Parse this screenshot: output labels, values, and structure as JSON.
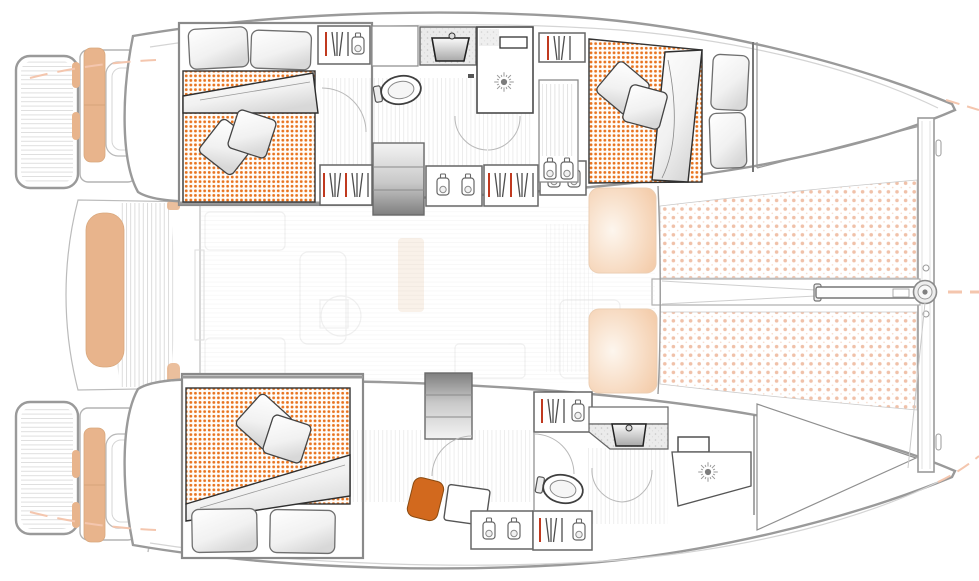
{
  "diagram": {
    "title": "Catamaran interior layout plan (top view)",
    "type": "boat-floor-plan",
    "view": "top-down",
    "orientation": {
      "bow": "right",
      "stern": "left"
    },
    "text_labels": [],
    "colors": {
      "mattress_dot": "#e8731e",
      "trampoline_dot": "#f0c1a9",
      "trampoline_dot_small": "#f7dccd",
      "upholstery_tan": "#e8b48c",
      "chair_orange": "#d2691e",
      "hanger_red": "#c0391f",
      "accent_dash": "#f4c6ae",
      "hull_outline": "#9a9a9a",
      "furniture_outline": "#4a4a4a",
      "window_glow": "#f2c49d"
    },
    "zones": {
      "starboard_hull_top": {
        "rooms": [
          {
            "name": "aft-cabin",
            "features": [
              "double-bed",
              "two-head-pillows",
              "two-decor-pillows",
              "dotted-mattress",
              "folded-duvet"
            ]
          },
          {
            "name": "corridor",
            "features": [
              "hanging-locker",
              "companionway-steps",
              "shelf-unit-bottles",
              "hanging-locker",
              "shelf-unit-bottles"
            ]
          },
          {
            "name": "bathroom",
            "features": [
              "vanity-sink",
              "toilet",
              "shower-stall-with-drain",
              "shower-shelf",
              "door-swing-arcs"
            ]
          },
          {
            "name": "forward-cabin",
            "features": [
              "double-bed",
              "two-head-pillows",
              "two-decor-pillows",
              "dotted-mattress",
              "folded-duvet",
              "hanging-locker",
              "louvered-cabinet-bottles"
            ]
          },
          {
            "name": "forepeak",
            "features": [
              "sail-locker"
            ]
          }
        ]
      },
      "port_hull_bottom": {
        "rooms": [
          {
            "name": "aft-cabin",
            "features": [
              "double-bed",
              "two-head-pillows",
              "two-decor-pillows",
              "dotted-mattress",
              "folded-duvet",
              "desk",
              "orange-chair"
            ]
          },
          {
            "name": "corridor",
            "features": [
              "companionway-steps",
              "hanging-locker",
              "shelf-unit-bottles",
              "hanging-locker"
            ]
          },
          {
            "name": "bathroom",
            "features": [
              "vanity-sink",
              "toilet",
              "shower-stall-with-drain",
              "shower-shelf",
              "door-swing-arcs"
            ]
          },
          {
            "name": "forepeak",
            "features": [
              "storage-locker"
            ]
          }
        ]
      },
      "center": {
        "areas": [
          {
            "name": "aft-cockpit",
            "features": [
              "curved-bench-tan",
              "teak-deck-planking",
              "transom-steps",
              "swim-platforms",
              "tan-cushions",
              "davits"
            ]
          },
          {
            "name": "saloon",
            "features": [
              "faint-furniture-outlines",
              "sliding-door"
            ]
          },
          {
            "name": "foredeck",
            "features": [
              "trampoline-upper",
              "trampoline-lower",
              "forward-crossbeam",
              "bowsprit-beam",
              "furler-drum",
              "bridle-lines",
              "coachroof-windows"
            ]
          }
        ]
      }
    },
    "fixture_counts": {
      "beds": 3,
      "toilets": 2,
      "sinks": 2,
      "showers": 2,
      "steps": 2,
      "hanging_lockers": 6,
      "bottle_shelves": 5
    }
  }
}
